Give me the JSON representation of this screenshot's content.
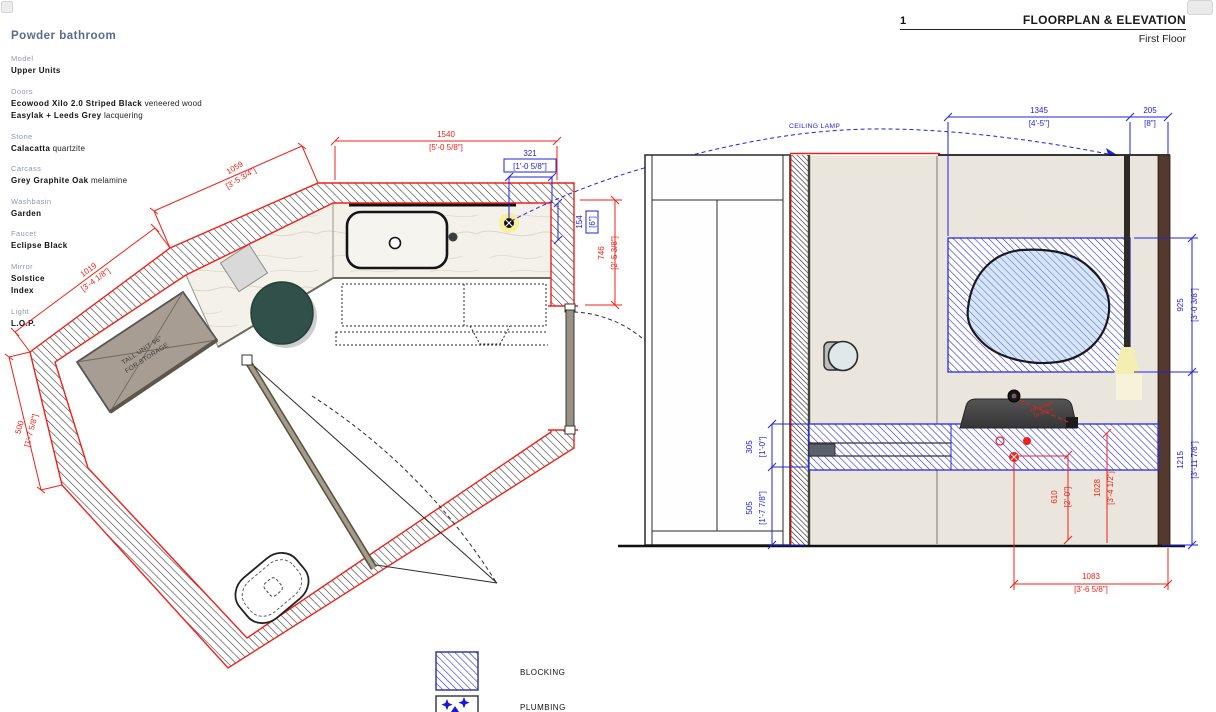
{
  "header": {
    "sheet_number": "1",
    "title": "FLOORPLAN & ELEVATION",
    "subtitle": "First Floor"
  },
  "spec": {
    "title": "Powder bathroom",
    "items": [
      {
        "label": "Model",
        "lines": [
          {
            "value": "Upper Units",
            "note": ""
          }
        ]
      },
      {
        "label": "Doors",
        "lines": [
          {
            "value": "Ecowood Xilo 2.0 Striped Black",
            "note": "veneered wood"
          },
          {
            "value": "Easylak + Leeds Grey",
            "note": "lacquering"
          }
        ]
      },
      {
        "label": "Stone",
        "lines": [
          {
            "value": "Calacatta",
            "note": "quartzite"
          }
        ]
      },
      {
        "label": "Carcass",
        "lines": [
          {
            "value": "Grey Graphite Oak",
            "note": "melamine"
          }
        ]
      },
      {
        "label": "Washbasin",
        "lines": [
          {
            "value": "Garden",
            "note": ""
          }
        ]
      },
      {
        "label": "Faucet",
        "lines": [
          {
            "value": "Eclipse",
            "note": "Black"
          }
        ]
      },
      {
        "label": "Mirror",
        "lines": [
          {
            "value": "Solstice",
            "note": ""
          },
          {
            "value": "Index",
            "note": ""
          }
        ]
      },
      {
        "label": "Light",
        "lines": [
          {
            "value": "L.O.P.",
            "note": ""
          }
        ]
      }
    ]
  },
  "plan": {
    "dims": {
      "d1540": {
        "v": "1540",
        "ft": "[5'-0 5/8\"]"
      },
      "d1059": {
        "v": "1059",
        "ft": "[3'-5 3/4\"]"
      },
      "d1019": {
        "v": "1019",
        "ft": "[3'-4 1/8\"]"
      },
      "d500": {
        "v": "500",
        "ft": "[1'-7 5/8\"]"
      },
      "d321": {
        "v": "321",
        "ft": "[1'-0 5/8\"]"
      },
      "d154": {
        "v": "154",
        "ft": "[6\"]"
      },
      "d746": {
        "v": "746",
        "ft": "[2'-5 3/8\"]"
      }
    },
    "labels": {
      "tall_unit_1": "TALL UNIT 96\"",
      "tall_unit_2": "FOR STORAGE"
    }
  },
  "elevation": {
    "dims": {
      "d1345": {
        "v": "1345",
        "ft": "[4'-5\"]"
      },
      "d205": {
        "v": "205",
        "ft": "[8\"]"
      },
      "d925": {
        "v": "925",
        "ft": "[3'-0 3/8\"]"
      },
      "d1215": {
        "v": "1215",
        "ft": "[3'-11 7/8\"]"
      },
      "d305": {
        "v": "305",
        "ft": "[1'-0\"]"
      },
      "d505": {
        "v": "505",
        "ft": "[1'-7 7/8\"]"
      },
      "d610": {
        "v": "610",
        "ft": "[2'-0\"]"
      },
      "d1028": {
        "v": "1028",
        "ft": "[3'-4 1/2\"]"
      },
      "d1083": {
        "v": "1083",
        "ft": "[3'-6 5/8\"]"
      }
    },
    "labels": {
      "ceiling_lamp": "CEILING LAMP",
      "connection_1": "connection",
      "connection_2": "by others"
    }
  },
  "legend": {
    "blocking": "BLOCKING",
    "plumbing": "PLUMBING"
  },
  "colors": {
    "dim_red": "#f32017",
    "dim_blue": "#2222dd",
    "wall_outline_red": "#f32017",
    "blocking_blue": "#2a2ae0",
    "wall_beige": "#ebe6dd",
    "marble": "#f3f1ea",
    "tall_unit_taupe": "#a79d92",
    "basin_green": "#31504a",
    "lamp_glow": "#f4eeb0",
    "fixture_dark": "#474747",
    "right_jamb_brown": "#543a2e"
  }
}
